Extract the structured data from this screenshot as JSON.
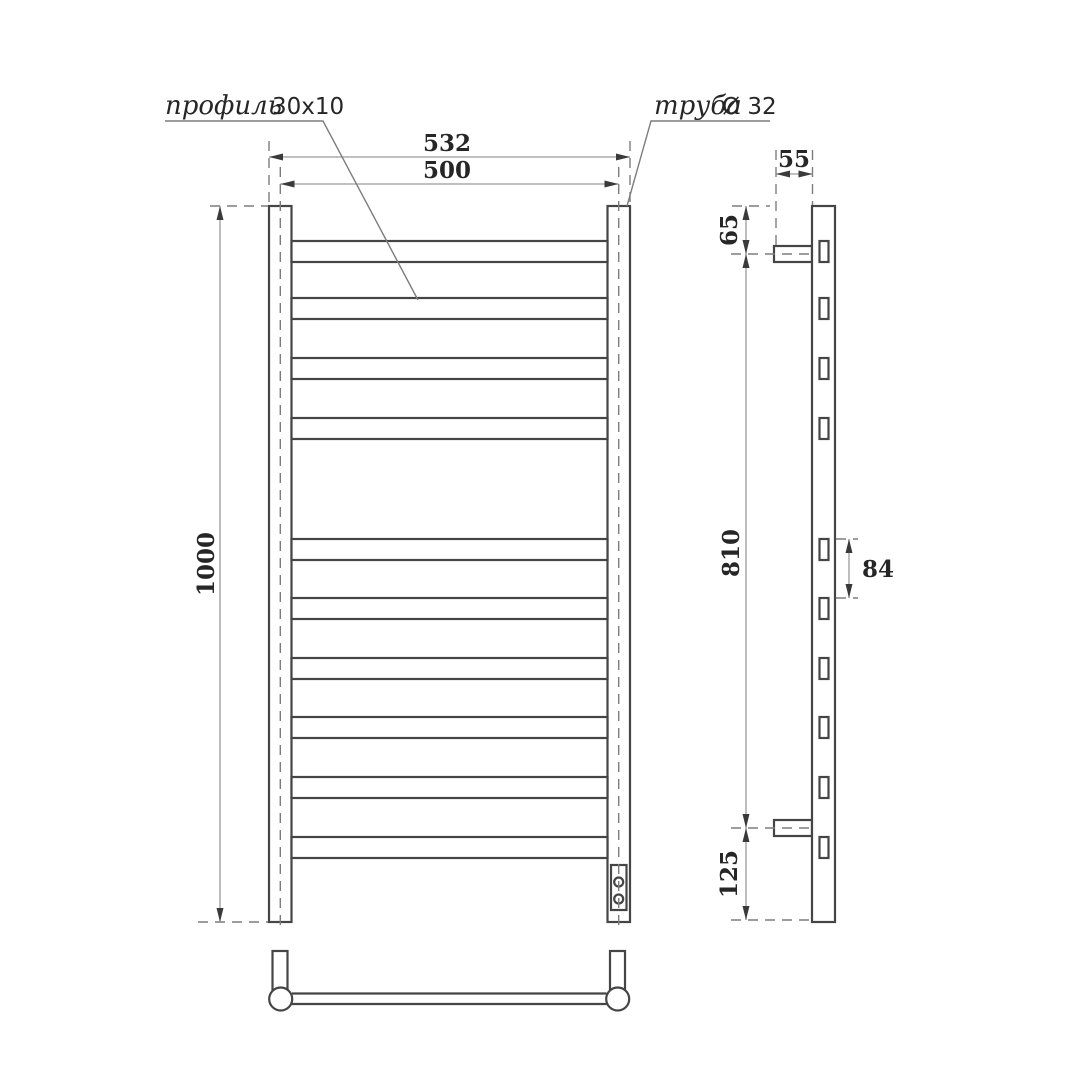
{
  "drawing": {
    "callouts": {
      "profile_word": "профиль",
      "profile_size": "30x10",
      "pipe_word": "труба",
      "pipe_size": "Ø 32"
    },
    "dimensions": {
      "front_outer_width": "532",
      "front_center_width": "500",
      "front_height": "1000",
      "side_depth": "55",
      "side_top_offset": "65",
      "side_bracket_span": "810",
      "side_rung_pitch": "84",
      "side_bottom_offset": "125"
    },
    "views": {
      "front_rung_count": 10,
      "side_rung_count": 10,
      "wall_bracket_count": 2
    },
    "colors": {
      "background": "#ffffff",
      "object_line": "#454545",
      "dimension_line": "#9a9a9a",
      "dash_line": "#7d7d7d",
      "arrow": "#3a3a3a",
      "text": "#262626"
    }
  }
}
